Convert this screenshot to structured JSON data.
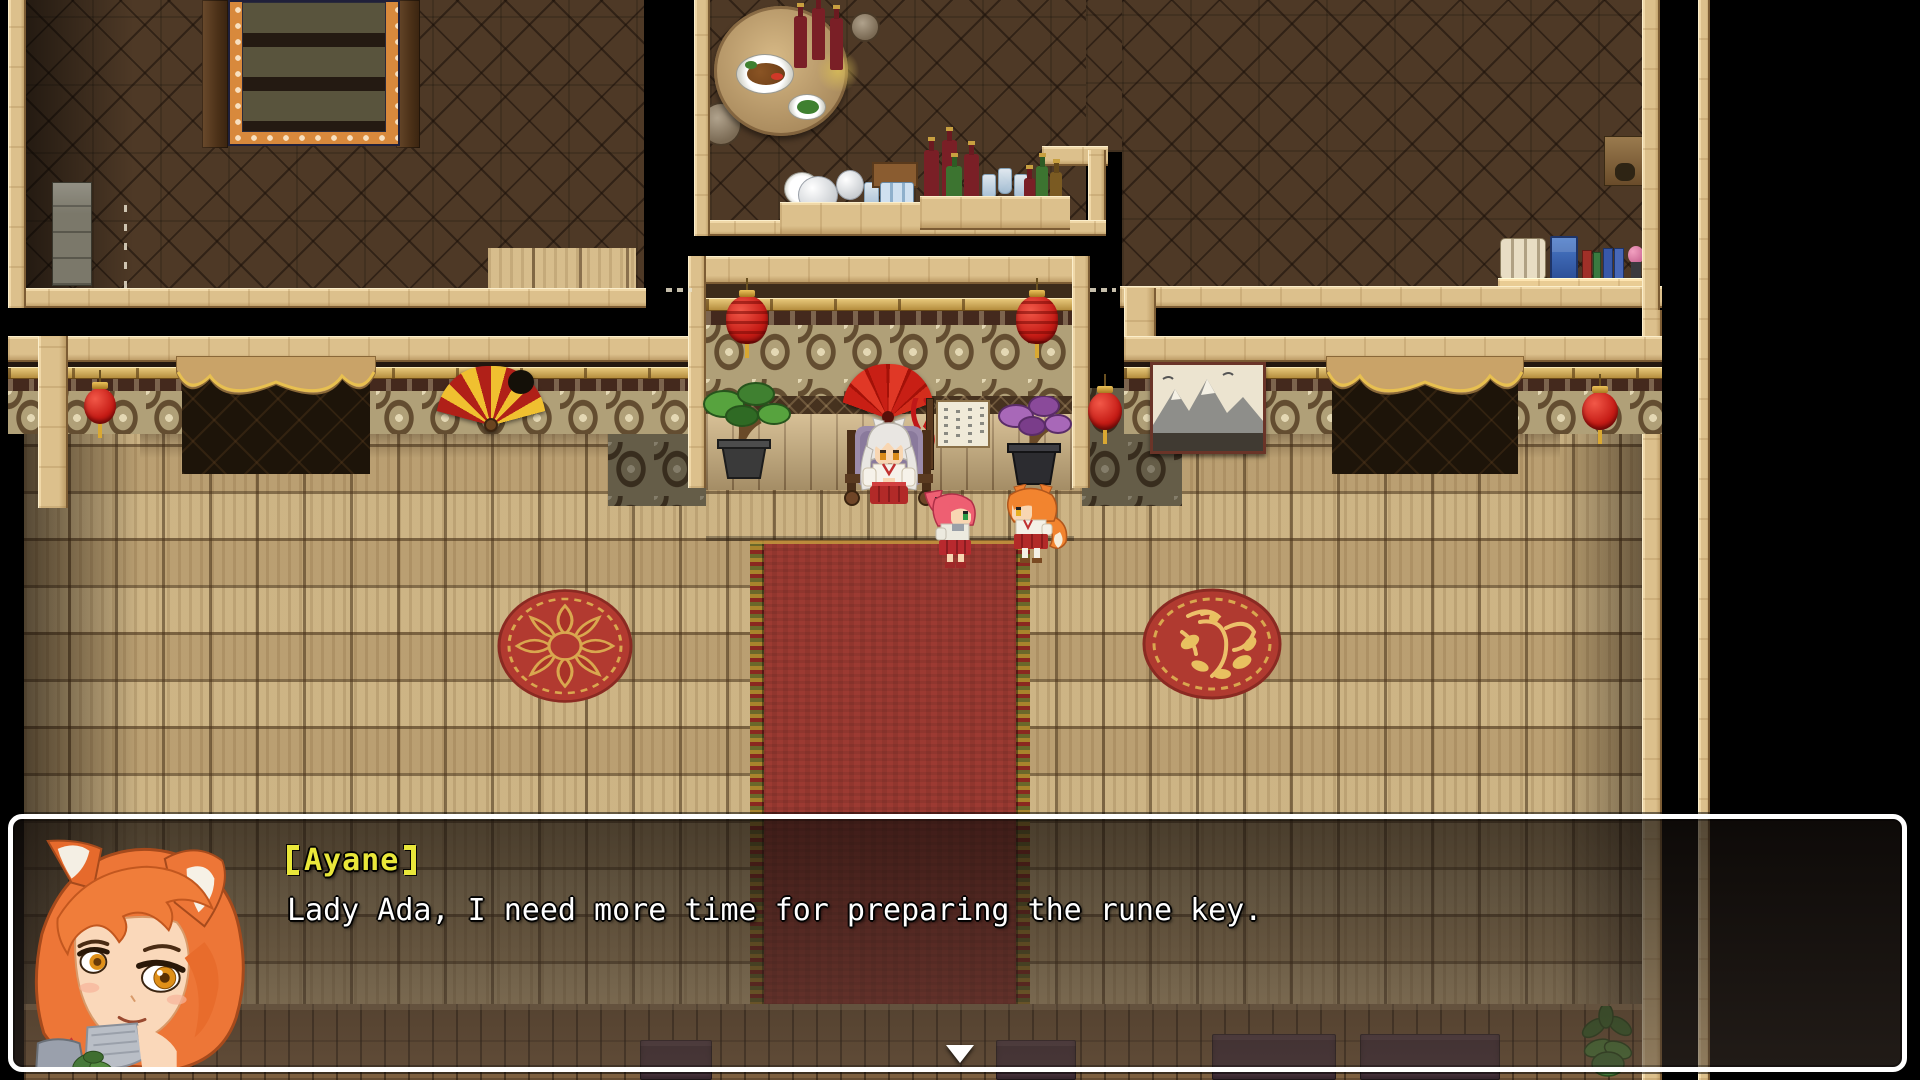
{
  "dialogue_window": {
    "speaker_name": "Ayane",
    "speaker_name_decorated": "【Ayane】",
    "line": "Lady Ada, I need more time for preparing the rune key.",
    "continue_indicator": "down-triangle-icon"
  },
  "colors": {
    "speaker_name": "#e9e73a",
    "dialogue_text": "#ffffff",
    "window_border": "#ffffff",
    "carpet_red": "#9c3a32",
    "floor_wood": "#c7ad7d",
    "wall_tan": "#b0a078",
    "lantern_red": "#cf1f1a",
    "gold_accent": "#d9a832",
    "map_background": "#000000"
  },
  "scene": {
    "rooms": [
      "upper-left-room",
      "upper-middle-room",
      "upper-right-room",
      "main-hall"
    ],
    "decorations": [
      "stair-runner-rug",
      "dining-table-with-food",
      "wine-bottles",
      "tea-set-counter",
      "glassware-counter",
      "book-and-scroll-shelf",
      "wall-banner",
      "red-lanterns",
      "door-curtains",
      "striped-wall-fan",
      "red-wall-fan",
      "notice-board",
      "green-bonsai",
      "purple-bonsai",
      "ink-landscape-painting",
      "lotus-round-rug",
      "phoenix-round-rug",
      "red-carpet",
      "benches",
      "potted-plant"
    ],
    "characters": [
      "white-haired-seated-figure",
      "pink-haired-figure",
      "orange-haired-figure"
    ]
  }
}
